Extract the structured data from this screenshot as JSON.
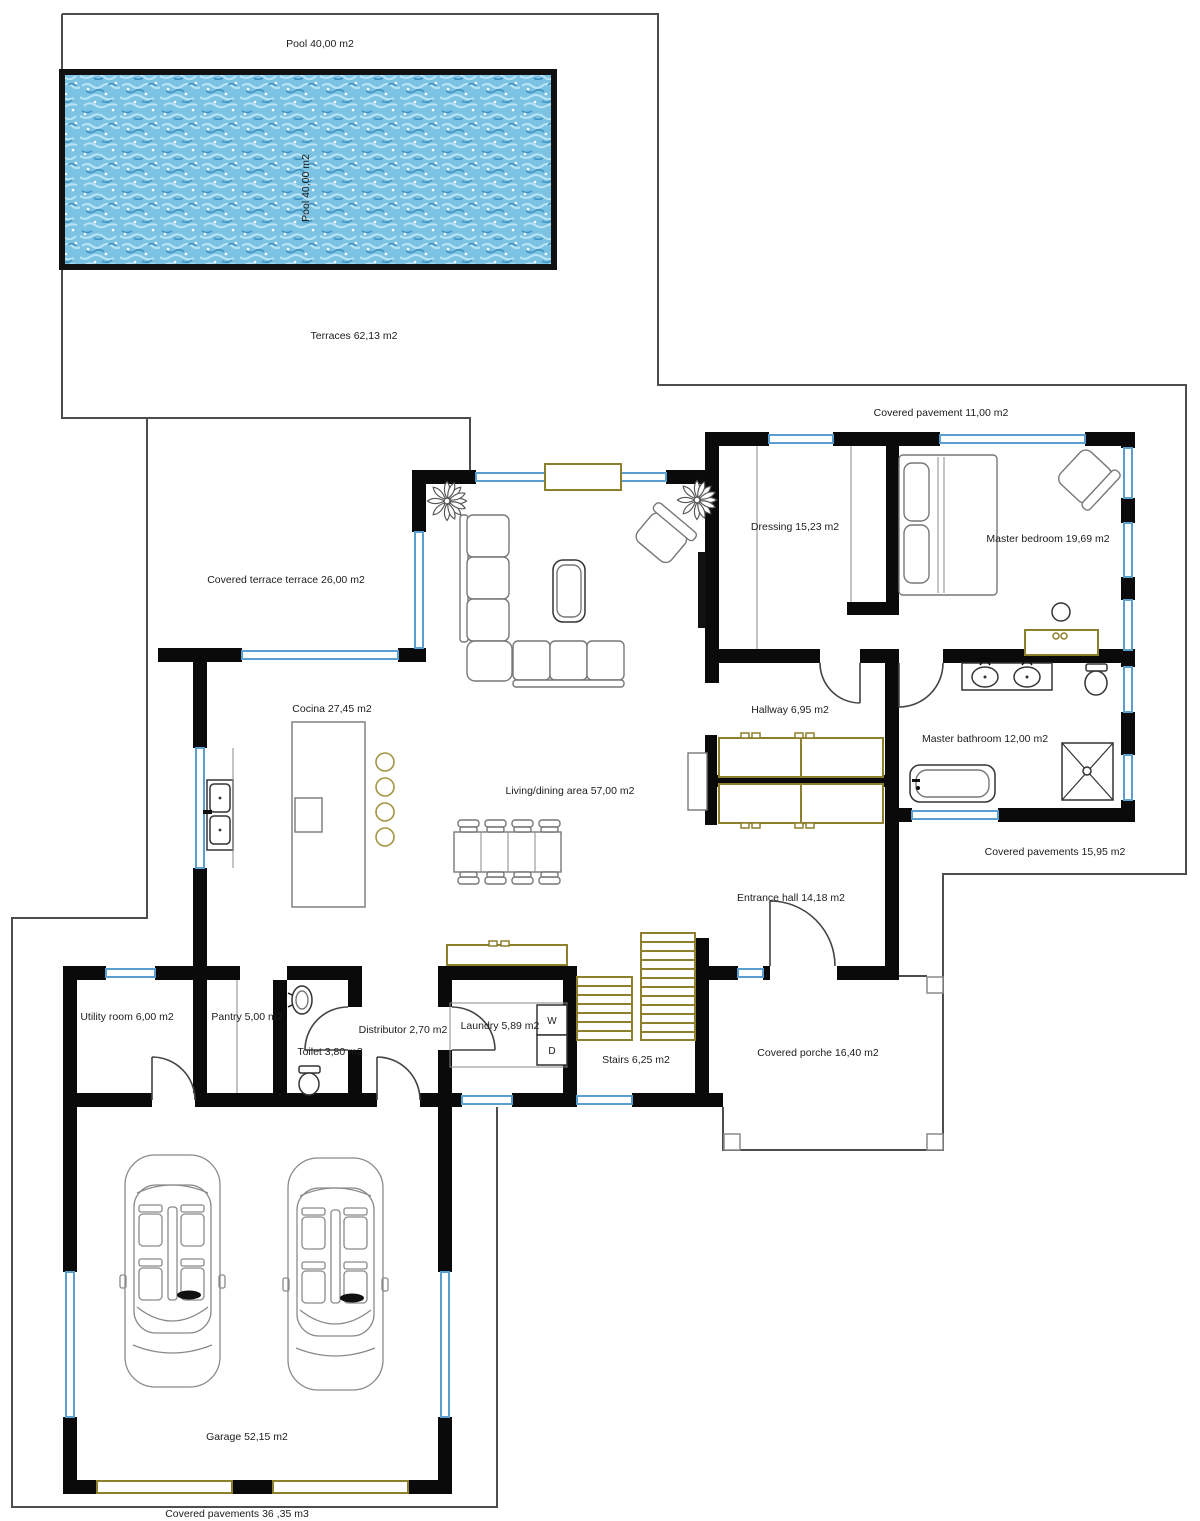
{
  "document_type": "architectural floor plan",
  "colors": {
    "wall": "#0a0a0a",
    "window_blue": "#5b9fd0",
    "gold": "#8e7f2c",
    "boundary": "#4d4d4d",
    "text": "#1c1c1c",
    "water_base": "#7cc2e3",
    "water_light": "#b8e4f5",
    "water_dark": "#3e92c2"
  },
  "labels": {
    "pool_top": "Pool 40,00 m2",
    "pool_side": "Pool 40,00 m2",
    "terraces": "Terraces 62,13 m2",
    "covered_pavement": "Covered pavement 11,00 m2",
    "covered_terrace": "Covered terrace terrace 26,00 m2",
    "dressing": "Dressing 15,23 m2",
    "master_bedroom": "Master bedroom 19,69 m2",
    "cocina": "Cocina 27,45 m2",
    "hallway": "Hallway 6,95 m2",
    "living_dining": "Living/dining area  57,00 m2",
    "master_bathroom": "Master bathroom 12,00 m2",
    "covered_pavements_right": "Covered pavements 15,95 m2",
    "entrance_hall": "Entrance hall 14,18 m2",
    "utility_room": "Utility room 6,00 m2",
    "pantry": "Pantry 5,00 m2",
    "toilet": "Toilet 3,80 m2",
    "distributor": "Distributor 2,70 m2",
    "laundry": "Laundry 5,89 m2",
    "washer": "W",
    "dryer": "D",
    "stairs": "Stairs 6,25 m2",
    "covered_porche": "Covered porche 16,40 m2",
    "garage": "Garage 52,15 m2",
    "covered_pavements_bottom": "Covered pavements 36 ,35 m3"
  }
}
